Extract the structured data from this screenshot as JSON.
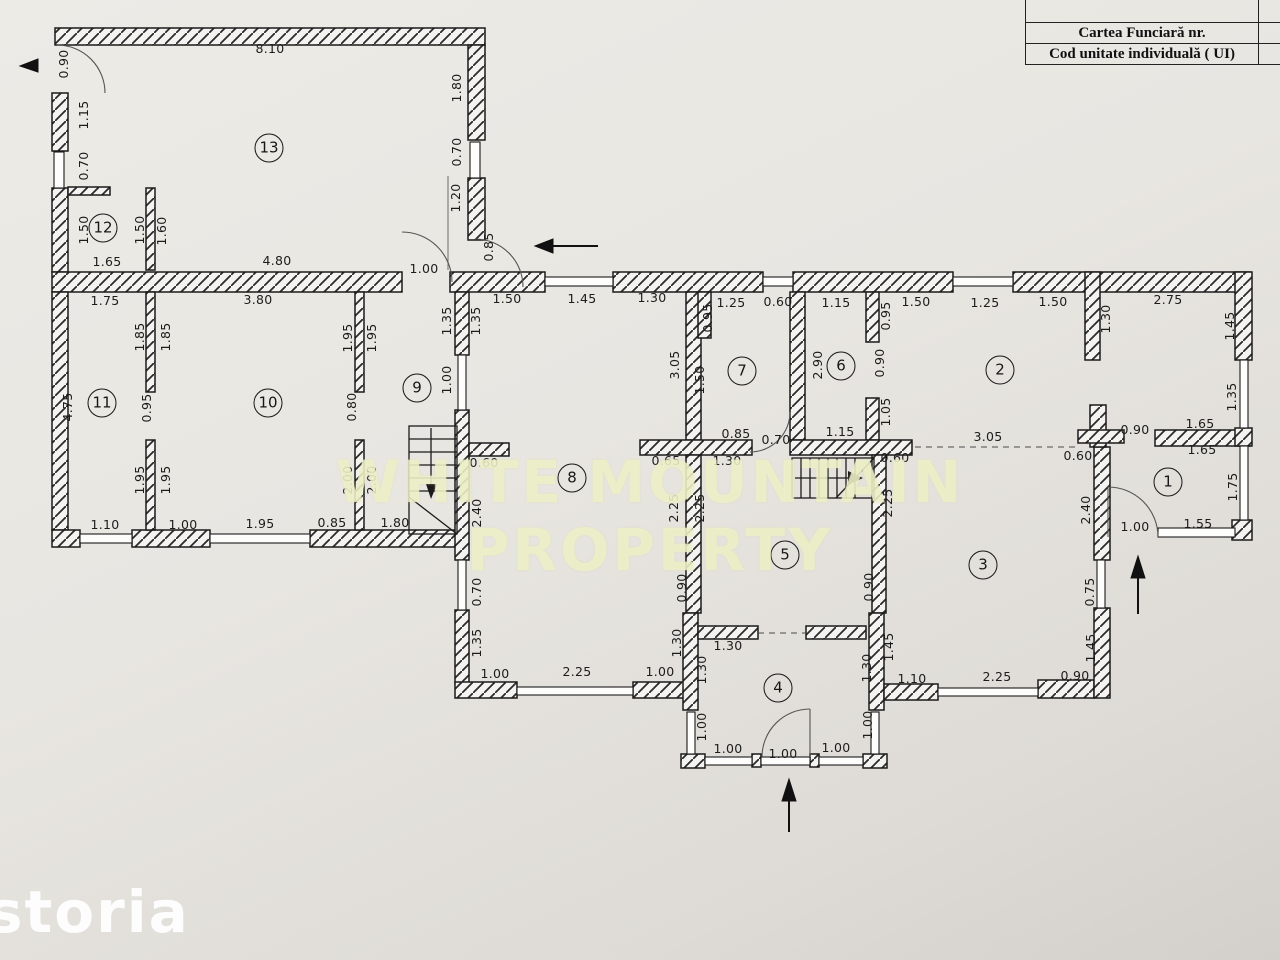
{
  "title_block": {
    "row1": "",
    "row2": "Cartea Funciară  nr.",
    "row3": "Cod unitate individuală ( UI)"
  },
  "watermark": {
    "center": "WHITE MOUNTAIN PROPERTY",
    "storia": "storia"
  },
  "colors": {
    "paper": "#e9e7e2",
    "ink": "#1b1b1b",
    "watermark_tint": "#eef1cb"
  },
  "plan": {
    "room_labels": [
      {
        "n": "1",
        "x": 1168,
        "y": 482
      },
      {
        "n": "2",
        "x": 1000,
        "y": 370
      },
      {
        "n": "3",
        "x": 983,
        "y": 565
      },
      {
        "n": "4",
        "x": 778,
        "y": 688
      },
      {
        "n": "5",
        "x": 785,
        "y": 555
      },
      {
        "n": "6",
        "x": 841,
        "y": 366
      },
      {
        "n": "7",
        "x": 742,
        "y": 371
      },
      {
        "n": "8",
        "x": 572,
        "y": 478
      },
      {
        "n": "9",
        "x": 417,
        "y": 388
      },
      {
        "n": "10",
        "x": 268,
        "y": 403
      },
      {
        "n": "11",
        "x": 102,
        "y": 403
      },
      {
        "n": "12",
        "x": 103,
        "y": 228
      },
      {
        "n": "13",
        "x": 269,
        "y": 148
      }
    ],
    "dim_labels": [
      {
        "t": "8.10",
        "x": 270,
        "y": 49,
        "v": 0
      },
      {
        "t": "0.90",
        "x": 64,
        "y": 64,
        "v": 1
      },
      {
        "t": "1.15",
        "x": 84,
        "y": 115,
        "v": 1
      },
      {
        "t": "0.70",
        "x": 84,
        "y": 166,
        "v": 1
      },
      {
        "t": "1.50",
        "x": 84,
        "y": 230,
        "v": 1
      },
      {
        "t": "1.50",
        "x": 140,
        "y": 230,
        "v": 1
      },
      {
        "t": "1.60",
        "x": 162,
        "y": 231,
        "v": 1
      },
      {
        "t": "1.65",
        "x": 107,
        "y": 262,
        "v": 0
      },
      {
        "t": "4.80",
        "x": 277,
        "y": 261,
        "v": 0
      },
      {
        "t": "1.80",
        "x": 457,
        "y": 88,
        "v": 1
      },
      {
        "t": "0.70",
        "x": 457,
        "y": 152,
        "v": 1
      },
      {
        "t": "1.20",
        "x": 456,
        "y": 198,
        "v": 1
      },
      {
        "t": "0.85",
        "x": 489,
        "y": 247,
        "v": 1
      },
      {
        "t": "1.00",
        "x": 424,
        "y": 269,
        "v": 0
      },
      {
        "t": "1.75",
        "x": 105,
        "y": 301,
        "v": 0
      },
      {
        "t": "3.80",
        "x": 258,
        "y": 300,
        "v": 0
      },
      {
        "t": "1.50",
        "x": 507,
        "y": 299,
        "v": 0
      },
      {
        "t": "1.45",
        "x": 582,
        "y": 299,
        "v": 0
      },
      {
        "t": "1.30",
        "x": 652,
        "y": 298,
        "v": 0
      },
      {
        "t": "1.25",
        "x": 731,
        "y": 303,
        "v": 0
      },
      {
        "t": "0.60",
        "x": 778,
        "y": 302,
        "v": 0
      },
      {
        "t": "1.15",
        "x": 836,
        "y": 303,
        "v": 0
      },
      {
        "t": "1.50",
        "x": 916,
        "y": 302,
        "v": 0
      },
      {
        "t": "1.25",
        "x": 985,
        "y": 303,
        "v": 0
      },
      {
        "t": "1.50",
        "x": 1053,
        "y": 302,
        "v": 0
      },
      {
        "t": "2.75",
        "x": 1168,
        "y": 300,
        "v": 0
      },
      {
        "t": "4.75",
        "x": 68,
        "y": 407,
        "v": 1
      },
      {
        "t": "1.85",
        "x": 140,
        "y": 337,
        "v": 1
      },
      {
        "t": "1.85",
        "x": 166,
        "y": 337,
        "v": 1
      },
      {
        "t": "0.95",
        "x": 147,
        "y": 408,
        "v": 1
      },
      {
        "t": "1.95",
        "x": 140,
        "y": 480,
        "v": 1
      },
      {
        "t": "1.95",
        "x": 166,
        "y": 480,
        "v": 1
      },
      {
        "t": "1.95",
        "x": 348,
        "y": 338,
        "v": 1
      },
      {
        "t": "1.95",
        "x": 372,
        "y": 338,
        "v": 1
      },
      {
        "t": "0.80",
        "x": 352,
        "y": 407,
        "v": 1
      },
      {
        "t": "2.00",
        "x": 348,
        "y": 480,
        "v": 1
      },
      {
        "t": "2.00",
        "x": 372,
        "y": 480,
        "v": 1
      },
      {
        "t": "1.10",
        "x": 105,
        "y": 525,
        "v": 0
      },
      {
        "t": "1.00",
        "x": 183,
        "y": 525,
        "v": 0
      },
      {
        "t": "1.95",
        "x": 260,
        "y": 524,
        "v": 0
      },
      {
        "t": "0.85",
        "x": 332,
        "y": 523,
        "v": 0
      },
      {
        "t": "1.80",
        "x": 395,
        "y": 523,
        "v": 0
      },
      {
        "t": "1.35",
        "x": 447,
        "y": 321,
        "v": 1
      },
      {
        "t": "1.35",
        "x": 476,
        "y": 321,
        "v": 1
      },
      {
        "t": "1.00",
        "x": 447,
        "y": 380,
        "v": 1
      },
      {
        "t": "0.60",
        "x": 484,
        "y": 463,
        "v": 0
      },
      {
        "t": "2.40",
        "x": 477,
        "y": 513,
        "v": 1
      },
      {
        "t": "0.70",
        "x": 477,
        "y": 592,
        "v": 1
      },
      {
        "t": "1.35",
        "x": 477,
        "y": 643,
        "v": 1
      },
      {
        "t": "1.00",
        "x": 495,
        "y": 674,
        "v": 0
      },
      {
        "t": "2.25",
        "x": 577,
        "y": 672,
        "v": 0
      },
      {
        "t": "1.00",
        "x": 660,
        "y": 672,
        "v": 0
      },
      {
        "t": "3.05",
        "x": 675,
        "y": 365,
        "v": 1
      },
      {
        "t": "0.95",
        "x": 708,
        "y": 318,
        "v": 1
      },
      {
        "t": "1.50",
        "x": 700,
        "y": 380,
        "v": 1
      },
      {
        "t": "0.85",
        "x": 736,
        "y": 434,
        "v": 0
      },
      {
        "t": "0.70",
        "x": 776,
        "y": 440,
        "v": 0
      },
      {
        "t": "0.65",
        "x": 666,
        "y": 461,
        "v": 0
      },
      {
        "t": "1.30",
        "x": 727,
        "y": 461,
        "v": 0
      },
      {
        "t": "2.25",
        "x": 674,
        "y": 508,
        "v": 1
      },
      {
        "t": "2.25",
        "x": 700,
        "y": 508,
        "v": 1
      },
      {
        "t": "2.90",
        "x": 818,
        "y": 365,
        "v": 1
      },
      {
        "t": "0.95",
        "x": 886,
        "y": 316,
        "v": 1
      },
      {
        "t": "0.90",
        "x": 880,
        "y": 363,
        "v": 1
      },
      {
        "t": "1.05",
        "x": 886,
        "y": 412,
        "v": 1
      },
      {
        "t": "1.15",
        "x": 840,
        "y": 432,
        "v": 0
      },
      {
        "t": "0.60",
        "x": 895,
        "y": 458,
        "v": 0
      },
      {
        "t": "2.25",
        "x": 888,
        "y": 503,
        "v": 1
      },
      {
        "t": "1.30",
        "x": 1106,
        "y": 319,
        "v": 1
      },
      {
        "t": "1.45",
        "x": 1230,
        "y": 326,
        "v": 1
      },
      {
        "t": "3.05",
        "x": 988,
        "y": 437,
        "v": 0
      },
      {
        "t": "0.90",
        "x": 1135,
        "y": 430,
        "v": 0
      },
      {
        "t": "1.65",
        "x": 1200,
        "y": 424,
        "v": 0
      },
      {
        "t": "1.65",
        "x": 1202,
        "y": 450,
        "v": 0
      },
      {
        "t": "1.35",
        "x": 1232,
        "y": 397,
        "v": 1
      },
      {
        "t": "0.60",
        "x": 1078,
        "y": 456,
        "v": 0
      },
      {
        "t": "2.40",
        "x": 1086,
        "y": 510,
        "v": 1
      },
      {
        "t": "1.75",
        "x": 1233,
        "y": 487,
        "v": 1
      },
      {
        "t": "1.00",
        "x": 1135,
        "y": 527,
        "v": 0
      },
      {
        "t": "1.55",
        "x": 1198,
        "y": 524,
        "v": 0
      },
      {
        "t": "0.90",
        "x": 682,
        "y": 588,
        "v": 1
      },
      {
        "t": "1.30",
        "x": 677,
        "y": 643,
        "v": 1
      },
      {
        "t": "1.30",
        "x": 728,
        "y": 646,
        "v": 0
      },
      {
        "t": "1.30",
        "x": 702,
        "y": 670,
        "v": 1
      },
      {
        "t": "1.00",
        "x": 702,
        "y": 727,
        "v": 1
      },
      {
        "t": "1.00",
        "x": 728,
        "y": 749,
        "v": 0
      },
      {
        "t": "1.00",
        "x": 783,
        "y": 754,
        "v": 0
      },
      {
        "t": "1.00",
        "x": 836,
        "y": 748,
        "v": 0
      },
      {
        "t": "0.90",
        "x": 869,
        "y": 587,
        "v": 1
      },
      {
        "t": "1.30",
        "x": 867,
        "y": 668,
        "v": 1
      },
      {
        "t": "1.45",
        "x": 889,
        "y": 647,
        "v": 1
      },
      {
        "t": "1.00",
        "x": 868,
        "y": 725,
        "v": 1
      },
      {
        "t": "1.10",
        "x": 912,
        "y": 679,
        "v": 0
      },
      {
        "t": "2.25",
        "x": 997,
        "y": 677,
        "v": 0
      },
      {
        "t": "0.90",
        "x": 1075,
        "y": 676,
        "v": 0
      },
      {
        "t": "0.75",
        "x": 1090,
        "y": 592,
        "v": 1
      },
      {
        "t": "1.45",
        "x": 1091,
        "y": 648,
        "v": 1
      }
    ]
  }
}
